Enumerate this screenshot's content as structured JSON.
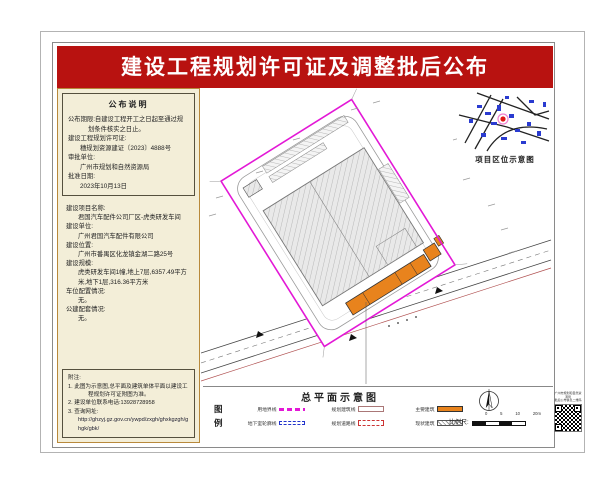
{
  "title": "建设工程规划许可证及调整批后公布",
  "left_panel": {
    "notice": {
      "heading": "公布说明",
      "lines": [
        "公布期限:自建设工程开工之日起至通过规划条件核实之日止。",
        "建设工程规划许可证:",
        "穗规划资源建证〔2023〕4888号",
        "审批单位:",
        "广州市规划和自然资源局",
        "批准日期:",
        "2023年10月13日"
      ]
    },
    "project": {
      "lines": [
        "建设项目名称:",
        "君国汽车配件公司厂区-虎类研发车间",
        "建设单位:",
        "广州君国汽车配件有限公司",
        "建设位置:",
        "广州市番禺区化龙镇金湖二路25号",
        "建设规模:",
        "虎类研发车间1幢,地上7层,6357.49平方米,地下1层,316.36平方米",
        "车位配置情况:",
        "无。",
        "公建配套情况:",
        "无。"
      ]
    },
    "notes": {
      "heading": "附注:",
      "items": [
        "1. 此图为示意图,总平面及建筑单体平面以建设工程规划许可证附图为准。",
        "2. 建设单位联系电话:13928728958",
        "3. 查询网址:",
        "http://ghzyj.gz.gov.cn/ywpd/zxgh/ghxkgzgh/ghgk/gbk/"
      ]
    }
  },
  "plan": {
    "location_map_caption": "项目区位示意图",
    "site_plan_caption": "总平面示意图",
    "legend": {
      "heading": "图例",
      "items": [
        {
          "label": "用地界线",
          "swatch": "magenta-dash"
        },
        {
          "label": "规划建筑线",
          "swatch": "outline"
        },
        {
          "label": "主要建筑",
          "swatch": "orange"
        },
        {
          "label": "地下室轮廓线",
          "swatch": "blue-dash"
        },
        {
          "label": "规划道路线",
          "swatch": "red-dash"
        },
        {
          "label": "现状建筑",
          "swatch": "hatch"
        }
      ]
    },
    "scale": {
      "label": "比例尺:",
      "ticks": [
        "0",
        "5",
        "10",
        "20m"
      ]
    },
    "qr": {
      "caption_line1": "广州市规划和自然资源局",
      "caption_line2": "批后公布信息二维码"
    }
  },
  "colors": {
    "title_red": "#b81210",
    "boundary_magenta": "#e318d6",
    "building_orange": "#e8831d",
    "panel_beige": "#f3eed8",
    "map_blue": "#2a3bd0"
  }
}
